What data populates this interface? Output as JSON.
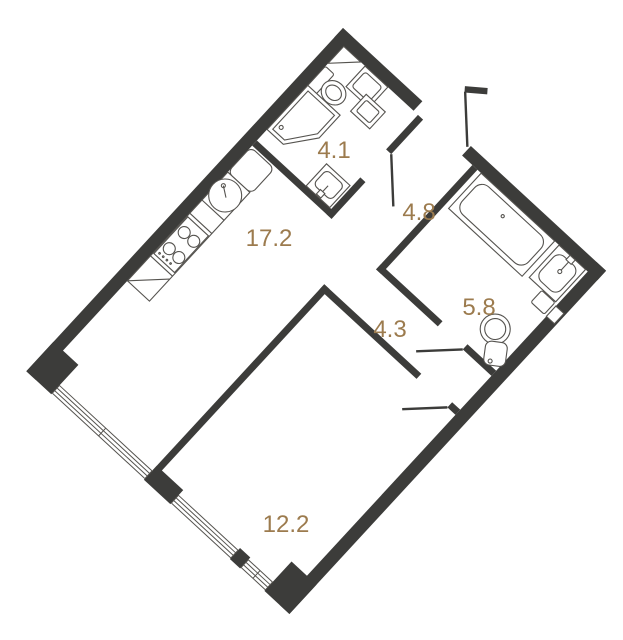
{
  "plan": {
    "type": "apartment-floor-plan",
    "rotation_deg": 42.7,
    "colors": {
      "wall": "#3c3c3a",
      "line": "#55534f",
      "label": "#9c7b4e",
      "background": "#ffffff"
    },
    "rooms": [
      {
        "id": "wc-combined",
        "area_label": "4.1",
        "label_x": 334,
        "label_y": 158
      },
      {
        "id": "kitchen-living",
        "area_label": "17.2",
        "label_x": 269,
        "label_y": 246
      },
      {
        "id": "corridor",
        "area_label": "4.8",
        "label_x": 419,
        "label_y": 220
      },
      {
        "id": "bathroom",
        "area_label": "5.8",
        "label_x": 479,
        "label_y": 315
      },
      {
        "id": "hallway",
        "area_label": "4.3",
        "label_x": 390,
        "label_y": 337
      },
      {
        "id": "living-room",
        "area_label": "12.2",
        "label_x": 286,
        "label_y": 532
      }
    ],
    "fixtures": [
      "corner-shelf",
      "toilet",
      "washing-machine",
      "shower-cabin",
      "wc-sink",
      "fridge",
      "kitchen-counter",
      "kitchen-sink",
      "stove",
      "bathtub",
      "bath-sink",
      "bath-toilet",
      "water-heater",
      "wall-niche",
      "entrance-door",
      "wc-door",
      "bathroom-door",
      "living-room-door",
      "window",
      "window",
      "window"
    ]
  }
}
